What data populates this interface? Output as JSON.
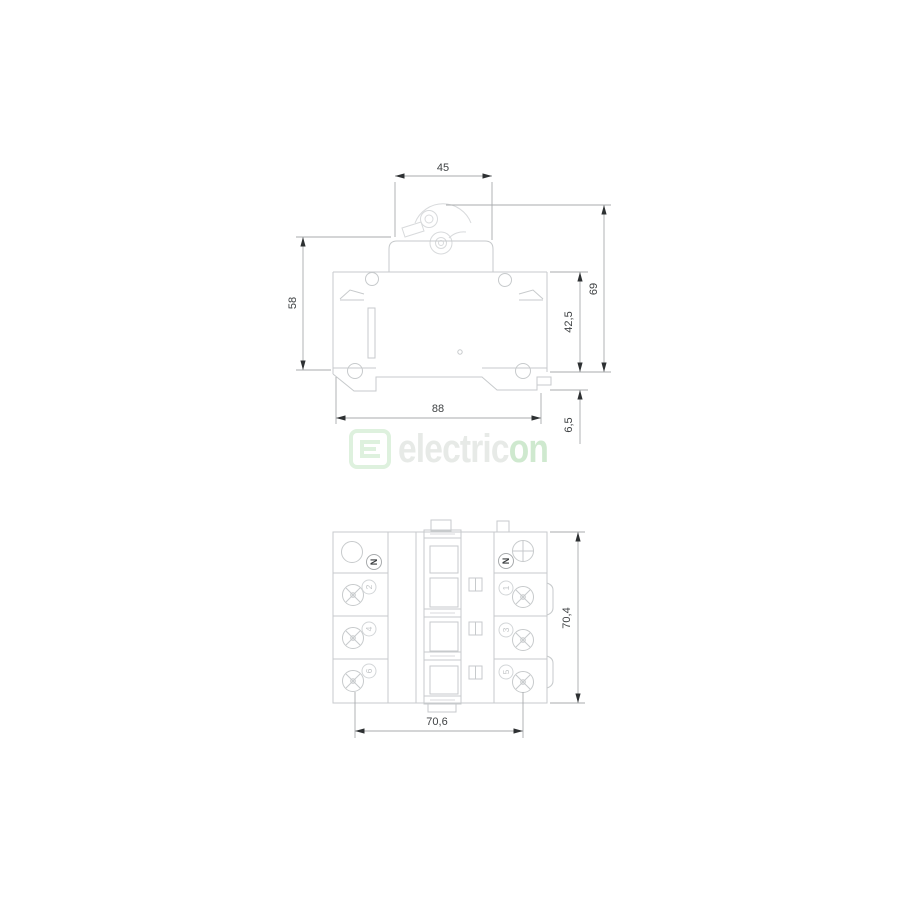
{
  "drawing": {
    "title": "circuit-breaker-dimension-drawing",
    "side_view": {
      "dims": {
        "top_width": "45",
        "left_height": "58",
        "total_height": "69",
        "body_height": "42,5",
        "base_width": "88",
        "rail_depth": "6,5"
      }
    },
    "bottom_view": {
      "dims": {
        "depth": "70,4",
        "terminal_span": "70,6"
      },
      "terminal_labels": {
        "left": [
          "N",
          "2",
          "4",
          "6"
        ],
        "right": [
          "N",
          "1",
          "3",
          "5"
        ]
      }
    }
  },
  "logo": {
    "word_primary": "electric",
    "word_accent": "on"
  },
  "colors": {
    "outline": "#c7cacc",
    "outline_faint": "#d8dadc",
    "dimension_line": "#a8abad",
    "arrow": "#2e3133",
    "dimension_text": "#3f4244",
    "logo_primary": "#e7eae7",
    "logo_accent": "#cfe9cf",
    "logo_mark": "#def1de"
  }
}
